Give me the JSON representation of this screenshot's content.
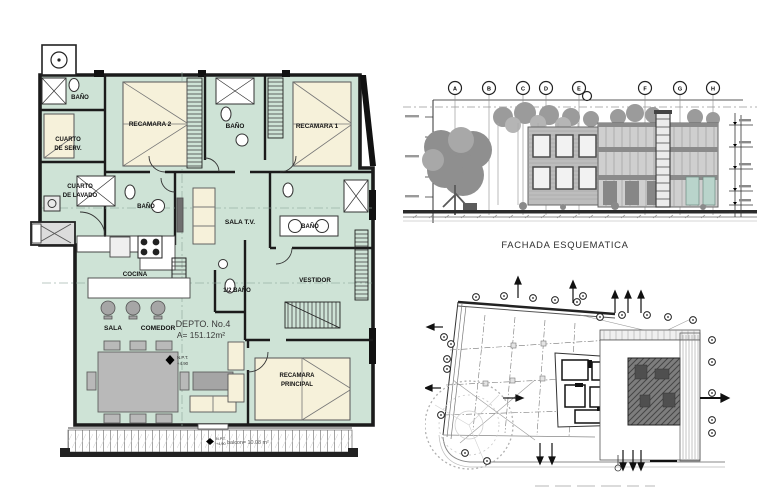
{
  "sheet": {
    "background": "#ffffff"
  },
  "floorplan": {
    "labels": {
      "bano_serv": "BAÑO",
      "cuarto_serv_1": "CUARTO",
      "cuarto_serv_2": "DE SERV.",
      "lavado_1": "CUARTO",
      "lavado_2": "DE LAVADO",
      "recamara2": "RECAMARA 2",
      "bano_top": "BAÑO",
      "recamara1": "RECAMARA 1",
      "bano_mid": "BAÑO",
      "sala_tv": "SALA T.V.",
      "bano_right": "BAÑO",
      "cocina": "COCINA",
      "medio_bano": "1/2 BAÑO",
      "vestidor": "VESTIDOR",
      "sala": "SALA",
      "comedor": "COMEDOR",
      "recamara_ppal_1": "RECAMARA",
      "recamara_ppal_2": "PRINCIPAL"
    },
    "unit": {
      "number": "DEPTO. No.4",
      "area": "A= 151.12m²"
    },
    "marks": {
      "npt": "N.P.T.",
      "npt_level": "+4.90",
      "balcony_npt": "N.P.T.",
      "balcony_level": "+4.90",
      "balcony_area": "balcon= 10.08 m²"
    },
    "colors": {
      "interior": "#cee3d6",
      "furniture": "#f6f1da",
      "wall": "#1b1b1b",
      "accent_gray": "#a6a6a6"
    }
  },
  "facade": {
    "caption": "FACHADA ESQUEMATICA",
    "grid": [
      "A",
      "B",
      "C",
      "D",
      "E",
      "F",
      "G",
      "H"
    ]
  }
}
